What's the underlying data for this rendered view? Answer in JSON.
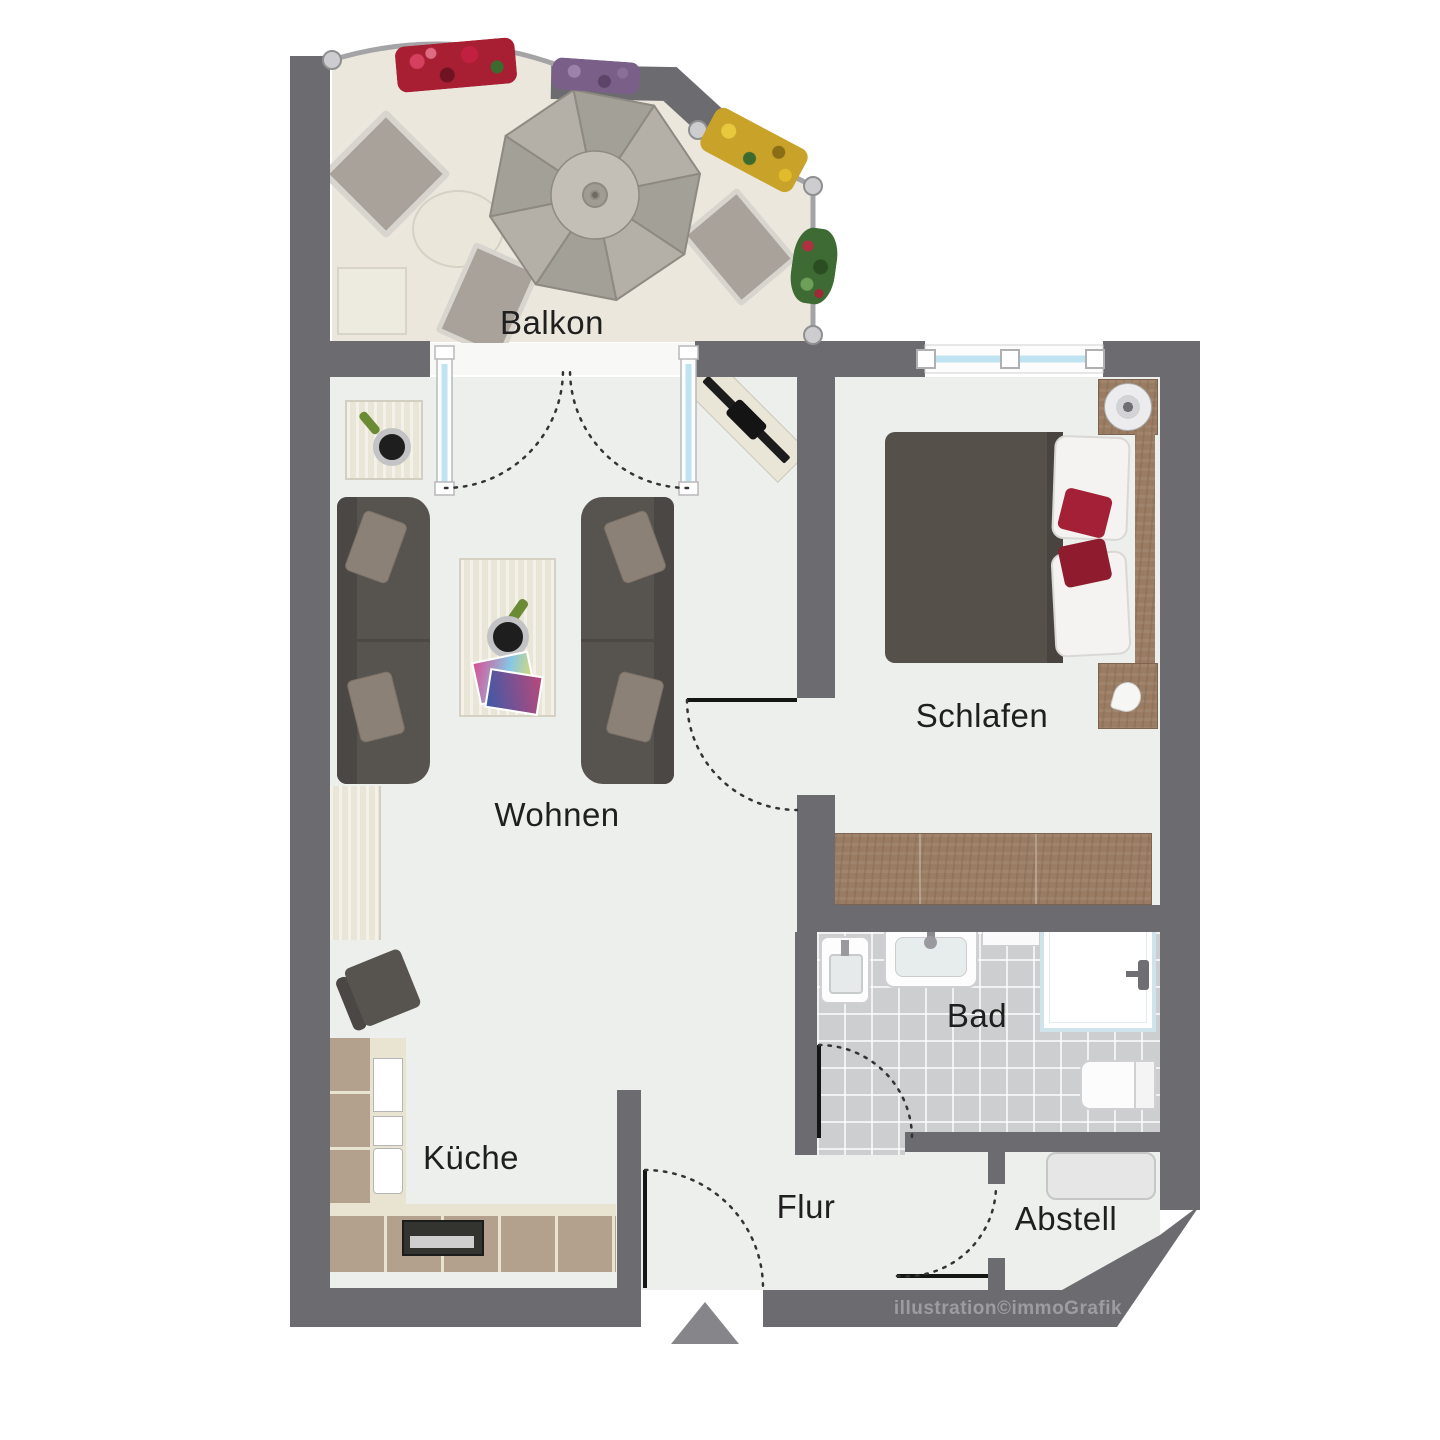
{
  "floorplan": {
    "rooms": [
      {
        "id": "balkon",
        "label": "Balkon"
      },
      {
        "id": "wohnen",
        "label": "Wohnen"
      },
      {
        "id": "schlafen",
        "label": "Schlafen"
      },
      {
        "id": "kueche",
        "label": "Küche"
      },
      {
        "id": "bad",
        "label": "Bad"
      },
      {
        "id": "flur",
        "label": "Flur"
      },
      {
        "id": "abstell",
        "label": "Abstell"
      }
    ],
    "watermark": "illustration©immoGrafik",
    "colors": {
      "wall": "#6c6c70",
      "floor": "#edefed",
      "balcony_floor": "#ebe7dc",
      "bath_tile": "#cdced0",
      "wood": "#9a7c63",
      "kitchen_cabinet": "#b3a18d",
      "sofa": "#57534f",
      "bed_duvet": "#56504a",
      "accent_pillow": "#a32036",
      "window_glass": "#bfe3f0",
      "label_ink": "#1f1f1f",
      "watermark_ink": "#9c9ca2",
      "entrance_arrow": "#85858a"
    }
  }
}
